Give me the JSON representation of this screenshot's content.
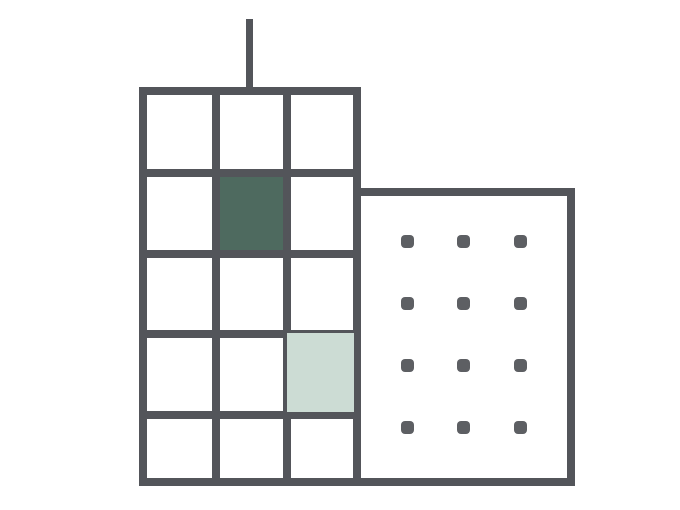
{
  "illustration": {
    "title": "two-buildings-pictogram",
    "colors": {
      "background": "#ffffff",
      "outline": "#53555a",
      "dot": "#5d5f63",
      "accent_dark": "#4e6a5f",
      "accent_light": "#ccdcd4"
    },
    "tall_building": {
      "rows": 5,
      "columns": 3,
      "highlighted_cells": [
        {
          "row": 2,
          "column": 2,
          "fill": "accent_dark"
        },
        {
          "row": 4,
          "column": 3,
          "fill": "accent_light"
        }
      ]
    },
    "wide_building": {
      "dot_rows": 4,
      "dot_columns": 3
    }
  }
}
